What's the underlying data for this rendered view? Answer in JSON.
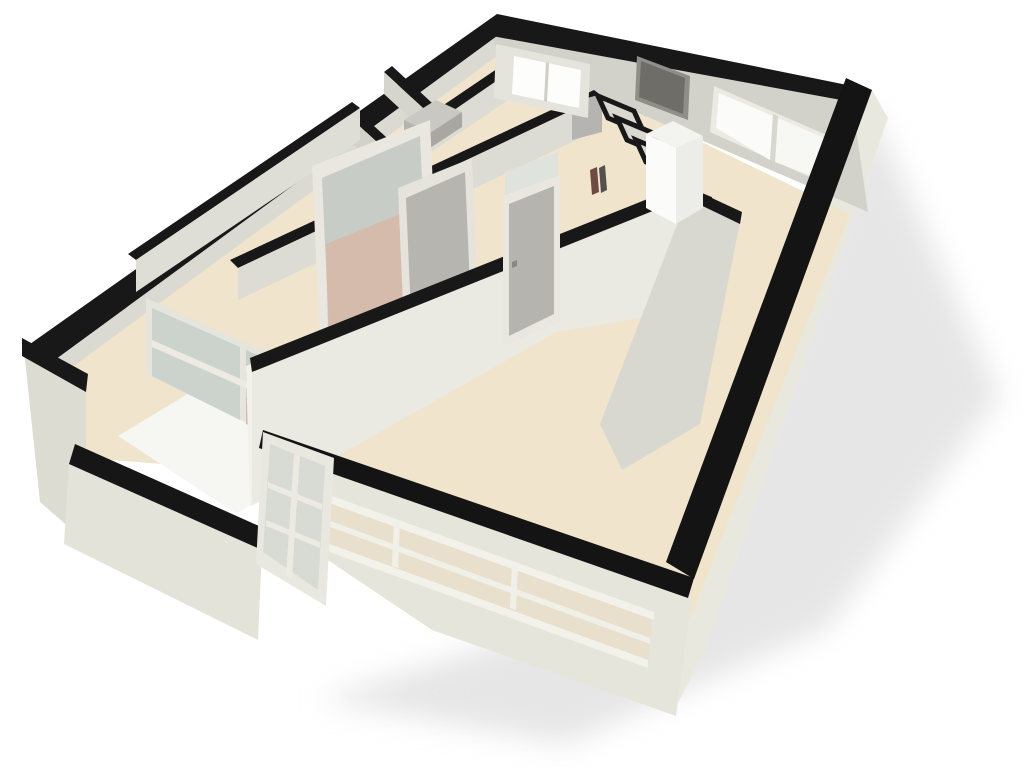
{
  "scene": {
    "description": "3D cutaway architectural floor plan render of an apartment, viewed from above at an angle. White/cream walls cut horizontally with black top edges, beige floors, a balcony with low parapet, interior doors, glazed partitions, a refrigerator, closet compartments and a soft drop shadow on a white background.",
    "canvas": {
      "width": 1024,
      "height": 768,
      "background": "#ffffff"
    },
    "palette": {
      "wall_cut_top": "#181818",
      "wall_face_light": "#eae9e2",
      "wall_face_mid": "#d8d7d0",
      "exterior_face": "#e6e5db",
      "floor_cream": "#f1e4cc",
      "floor_white": "#f6f6f3",
      "floor_salmon": "#d8b6a4",
      "glass": "#ccd2cc",
      "door_gray": "#b6b4af",
      "fridge_white": "#fbfbf9",
      "shadow": "#d9d9d9"
    },
    "shapes": [
      {
        "name": "drop-shadow",
        "fill": "#d9d9d9",
        "opacity": 0.65,
        "blur": true,
        "points": "868,100 1000,396 828,628 566,744 318,700 690,582 868,120"
      },
      {
        "name": "se-exterior-wall-face",
        "fill": "#e9e8de",
        "points": "872,90 888,118 706,648 672,714 650,690 694,579"
      },
      {
        "name": "apartment-floor-base",
        "fill": "#f1e4cc",
        "points": "58,368 500,44 850,214 674,660 300,540 240,470 60,456"
      },
      {
        "name": "balcony-floor",
        "fill": "#f6f6f3",
        "points": "118,436 234,366 342,440 237,514"
      },
      {
        "name": "nw-wall-inner-face",
        "fill": "#dad9d2",
        "points": "52,362 497,36 497,56 52,382"
      },
      {
        "name": "ne-wall-inner-face",
        "fill": "#d3d2ca",
        "points": "492,34 852,100 868,212 497,52"
      },
      {
        "name": "ne-window-frame",
        "fill": "#eceae2",
        "points": "714,86 838,140 834,188 710,132"
      },
      {
        "name": "ne-window-glass-left",
        "fill": "#fbfbf9",
        "points": "719,93 773,116 770,160 716,128"
      },
      {
        "name": "ne-window-glass-right",
        "fill": "#f7f7f4",
        "points": "778,118 831,141 828,182 775,162"
      },
      {
        "name": "ne-window-mullion",
        "fill": "#d8d7cf",
        "points": "773,114 778,116 775,162 770,160"
      },
      {
        "name": "nw-wall-cut-band",
        "fill": "#181818",
        "points": "30,344 497,14 497,36 52,362"
      },
      {
        "name": "ne-wall-cut-band",
        "fill": "#181818",
        "points": "497,14 872,90 852,102 492,36"
      },
      {
        "name": "se-wall-cut-band",
        "fill": "#141414",
        "points": "872,90 694,579 666,562 846,78"
      },
      {
        "name": "bathroom-wall-face",
        "fill": "#dcdbd4",
        "points": "322,196 520,62 520,92 322,226"
      },
      {
        "name": "bathroom-wall-cut-band",
        "fill": "#181818",
        "points": "318,190 516,56 524,62 326,198"
      },
      {
        "name": "bathroom-divider-band-1",
        "fill": "#181818",
        "points": "350,104 398,148 390,154 342,110"
      },
      {
        "name": "bathroom-divider-face-1",
        "fill": "#d2d1ca",
        "points": "342,110 390,154 390,178 342,134"
      },
      {
        "name": "bathroom-divider-band-2",
        "fill": "#181818",
        "points": "392,66 444,114 436,120 384,72"
      },
      {
        "name": "bathroom-divider-face-2",
        "fill": "#d5d4cd",
        "points": "384,72 436,120 436,142 384,94"
      },
      {
        "name": "shower-fixture-top",
        "fill": "#c9c8c2",
        "points": "404,120 436,100 462,112 430,133"
      },
      {
        "name": "shower-fixture-front",
        "fill": "#b4b3ad",
        "points": "404,120 430,133 430,148 404,135"
      },
      {
        "name": "shower-fixture-side",
        "fill": "#a8a7a1",
        "points": "430,133 462,112 462,127 430,148"
      },
      {
        "name": "corridor-wall-cut-band",
        "fill": "#181818",
        "points": "230,260 594,90 602,96 238,268"
      },
      {
        "name": "corridor-wall-face",
        "fill": "#dcdbd4",
        "points": "238,268 602,96 602,128 238,300"
      },
      {
        "name": "interior-door-top-room",
        "fill": "#b6b4b0",
        "points": "572,102 602,94 602,132 572,140"
      },
      {
        "name": "bedroom-north-wall-cut-band",
        "fill": "#181818",
        "points": "128,254 352,102 360,108 136,260"
      },
      {
        "name": "bedroom-north-wall-face",
        "fill": "#deddd6",
        "points": "136,260 360,108 360,140 136,292"
      },
      {
        "name": "glazed-partition-wall-face",
        "fill": "#e4e3dc",
        "points": "496,44 590,64 588,118 494,98"
      },
      {
        "name": "glazed-partition-window",
        "fill": "#fdfdfc",
        "points": "514,56 581,70 579,108 512,94"
      },
      {
        "name": "glazed-partition-mullion",
        "fill": "#cfcec7",
        "points": "546,62 549,63 547,102 544,101"
      },
      {
        "name": "entry-door-frame",
        "fill": "#8f8e88",
        "points": "637,56 690,76 688,120 635,100"
      },
      {
        "name": "entry-door-panel",
        "fill": "#6e6d68",
        "points": "641,61 685,78 683,114 639,97"
      },
      {
        "name": "closet-cell-1",
        "fill": "#d9d8d1",
        "stroke": "#181818",
        "strokeWidth": 5,
        "points": "598,96 634,111 644,133 608,118"
      },
      {
        "name": "closet-cell-2",
        "fill": "#d9d8d1",
        "stroke": "#181818",
        "strokeWidth": 5,
        "points": "617,118 653,133 663,155 627,140"
      },
      {
        "name": "closet-cell-3",
        "fill": "#d9d8d1",
        "stroke": "#181818",
        "strokeWidth": 5,
        "points": "636,140 672,155 682,177 646,162"
      },
      {
        "name": "closet-cell-4",
        "fill": "#d9d8d1",
        "stroke": "#181818",
        "strokeWidth": 5,
        "points": "655,162 691,177 701,199 665,184"
      },
      {
        "name": "closet-cell-5",
        "fill": "#d9d8d1",
        "stroke": "#181818",
        "strokeWidth": 5,
        "points": "674,184 710,199 720,221 684,206"
      },
      {
        "name": "utility-object-1",
        "fill": "#6d4a42",
        "points": "590,170 597,167 599,192 592,195"
      },
      {
        "name": "utility-object-2",
        "fill": "#54504e",
        "points": "599,168 605,165 607,190 601,193"
      },
      {
        "name": "sliding-door-frame",
        "fill": "#e9e7e0",
        "points": "312,166 430,120 438,300 320,348"
      },
      {
        "name": "sliding-door-glass",
        "fill": "#c7ccc6",
        "points": "322,178 420,136 427,288 329,332"
      },
      {
        "name": "sliding-door-glass-salmon",
        "fill": "#d8b6a4",
        "opacity": 0.8,
        "points": "326,244 425,204 427,288 328,330"
      },
      {
        "name": "hall-door-frame",
        "fill": "#e5e3db",
        "points": "398,188 472,158 478,298 404,330"
      },
      {
        "name": "hall-door-panel",
        "fill": "#b7b5b0",
        "points": "406,198 465,172 470,286 411,315"
      },
      {
        "name": "bedroom-floor-sliver",
        "fill": "#dcb4a0",
        "points": "342,402 392,376 404,398 354,426"
      },
      {
        "name": "balcony-glazing-frame",
        "fill": "#e6e5dd",
        "points": "146,298 340,384 340,468 146,374"
      },
      {
        "name": "balcony-glazing-pane-left",
        "fill": "#ccd2cc",
        "points": "152,308 240,347 240,420 152,376"
      },
      {
        "name": "balcony-glazing-pane-right",
        "fill": "#c9cfc9",
        "points": "246,350 334,389 334,460 246,424"
      },
      {
        "name": "balcony-glazing-salmon",
        "fill": "#d7b5a3",
        "opacity": 0.7,
        "points": "246,398 334,430 334,460 246,424"
      },
      {
        "name": "balcony-glazing-rail",
        "fill": "#eceae3",
        "points": "152,340 334,420 334,427 152,347"
      },
      {
        "name": "living-wall-cut-end",
        "fill": "#f2f1ea",
        "points": "246,366 256,362 260,502 250,506"
      },
      {
        "name": "living-north-wall-face",
        "fill": "#eae9e2",
        "points": "252,368 688,192 688,310 556,332 252,505"
      },
      {
        "name": "living-north-wall-cut-band",
        "fill": "#181818",
        "points": "250,358 690,182 690,196 252,372"
      },
      {
        "name": "living-door-transom",
        "fill": "#dfe3de",
        "points": "505,172 558,152 558,178 505,198"
      },
      {
        "name": "living-door-frame",
        "fill": "#e9e7e0",
        "points": "503,196 560,175 560,322 503,346"
      },
      {
        "name": "living-door-panel",
        "fill": "#b6b4af",
        "points": "509,204 554,186 554,314 509,336"
      },
      {
        "name": "living-door-handle",
        "fill": "#8a8984",
        "points": "512,262 517,260 517,266 512,268"
      },
      {
        "name": "kitchen-divider-face",
        "fill": "#d8d7d0",
        "points": "688,196 740,222 700,424 622,470 600,424"
      },
      {
        "name": "kitchen-divider-cut-band",
        "fill": "#181818",
        "points": "686,186 742,212 740,224 686,198"
      },
      {
        "name": "fridge-front",
        "fill": "#fbfbf9",
        "points": "646,134 676,148 676,224 646,208"
      },
      {
        "name": "fridge-side",
        "fill": "#ecece9",
        "points": "676,148 703,136 703,208 676,224"
      },
      {
        "name": "fridge-top",
        "fill": "#f3f3f0",
        "points": "646,134 673,121 703,136 676,148"
      },
      {
        "name": "west-stub-wall-face",
        "fill": "#dddcd2",
        "points": "24,350 86,388 86,542 40,502"
      },
      {
        "name": "west-stub-wall-cut-band",
        "fill": "#181818",
        "points": "22,338 88,374 86,392 22,356"
      },
      {
        "name": "parapet-face",
        "fill": "#e4e3d9",
        "points": "69,462 262,548 258,640 64,544"
      },
      {
        "name": "parapet-cut-band",
        "fill": "#161616",
        "points": "75,444 268,530 262,550 69,464"
      },
      {
        "name": "front-wall-face",
        "fill": "#e6e5db",
        "points": "261,446 692,596 676,716 432,630 298,540"
      },
      {
        "name": "front-window-interior-view",
        "fill": "#e9dfcd",
        "points": "284,484 652,618 648,664 280,530"
      },
      {
        "name": "front-window-frame-top",
        "fill": "#f3f2ea",
        "points": "282,478 654,612 654,620 282,486"
      },
      {
        "name": "front-window-sill",
        "fill": "#f3f2ea",
        "points": "280,526 648,660 648,668 280,534"
      },
      {
        "name": "front-window-rail",
        "fill": "#f1f0e8",
        "points": "284,504 650,638 650,644 284,510"
      },
      {
        "name": "front-window-mullion-1",
        "fill": "#f1f0e8",
        "points": "394,520 400,522 398,568 392,566"
      },
      {
        "name": "front-window-mullion-2",
        "fill": "#f1f0e8",
        "points": "512,564 518,566 516,610 510,608"
      },
      {
        "name": "front-wall-cut-band",
        "fill": "#141414",
        "points": "263,430 694,578 688,598 259,448"
      },
      {
        "name": "balcony-door-frame",
        "fill": "#e9e8e0",
        "points": "263,432 334,458 326,606 256,564"
      },
      {
        "name": "balcony-door-glass",
        "fill": "#d7dbd4",
        "points": "270,444 325,466 318,590 263,552"
      },
      {
        "name": "balcony-door-rail-1",
        "fill": "#eceae2",
        "points": "268,482 322,504 322,510 268,488"
      },
      {
        "name": "balcony-door-rail-2",
        "fill": "#eceae2",
        "points": "266,520 320,542 320,548 266,526"
      },
      {
        "name": "balcony-door-stile",
        "fill": "#eceae2",
        "points": "294,454 300,456 292,578 286,576"
      }
    ]
  }
}
